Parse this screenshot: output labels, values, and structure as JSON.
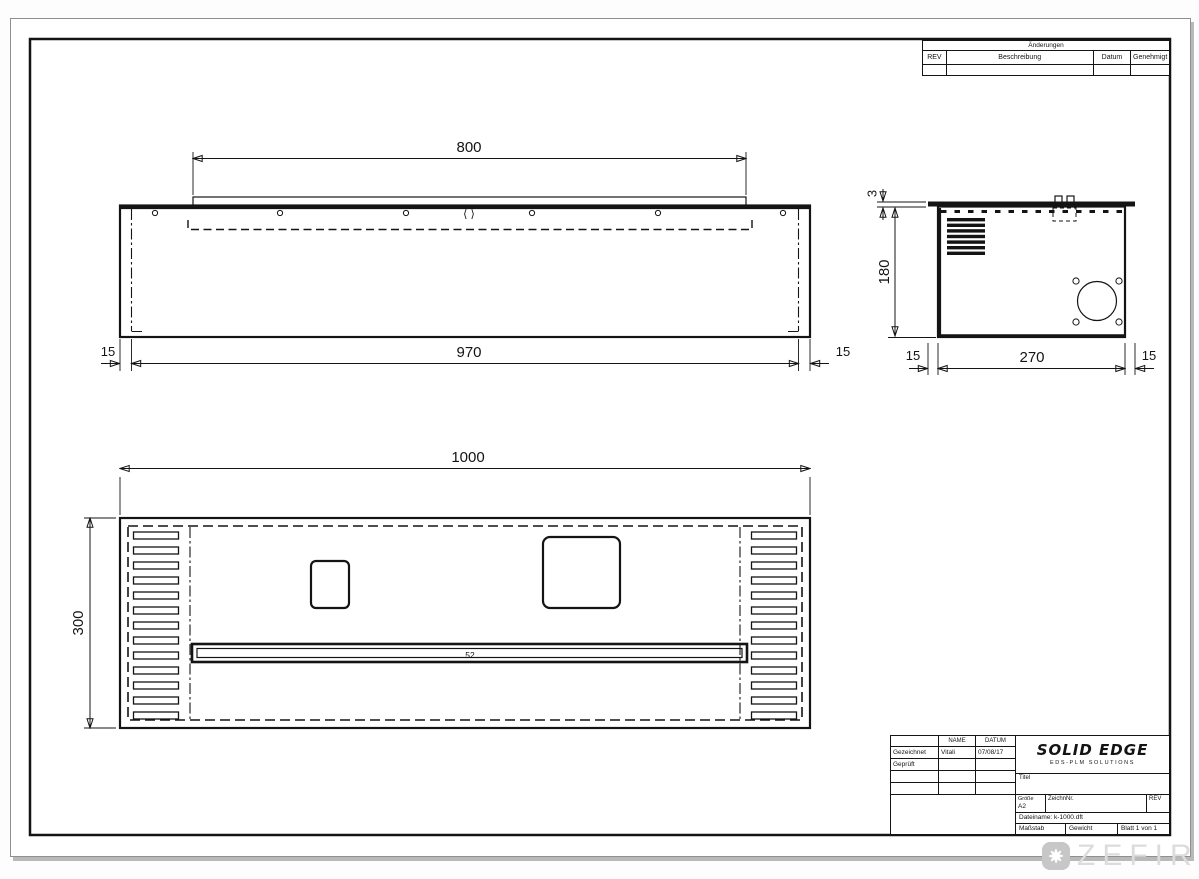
{
  "drawing": {
    "revision_table": {
      "title": "Änderungen",
      "col_rev": "REV",
      "col_desc": "Beschreibung",
      "col_date": "Datum",
      "col_approved": "Genehmigt"
    },
    "title_block": {
      "name_header": "NAME",
      "date_header": "DATUM",
      "row1_label": "Gezeichnet",
      "row1_name": "Vitali",
      "row1_date": "07/08/17",
      "row2_label": "Geprüft",
      "logo_title": "SOLID EDGE",
      "logo_subtitle": "EDS-PLM SOLUTIONS",
      "title_label": "Titel",
      "size_label": "Größe",
      "size_value": "A2",
      "drawing_no_label": "ZeichnNr.",
      "rev_label": "REV",
      "filename": "Dateiname: k-1000.dft",
      "scale_label": "Maßstab",
      "weight_label": "Gewicht",
      "sheet_label": "Blatt 1 von 1"
    },
    "dims": {
      "front_top_width": "800",
      "front_bottom_width": "970",
      "front_left_offset": "15",
      "front_right_offset": "15",
      "front_center_mark": "⟨ ⟩",
      "side_lip": "3",
      "side_height": "180",
      "side_depth": "270",
      "side_left_offset": "15",
      "side_right_offset": "15",
      "plan_width": "1000",
      "plan_depth": "300",
      "plan_slot": "52"
    },
    "watermark": {
      "text": "ZEFIRE",
      "icon": "pinwheel-icon"
    },
    "colors": {
      "line": "#141414",
      "sheet": "#ffffff",
      "shadow": "#b9b9b9",
      "watermark_text": "#dcdcdc",
      "watermark_badge": "#c7c7c7"
    }
  }
}
